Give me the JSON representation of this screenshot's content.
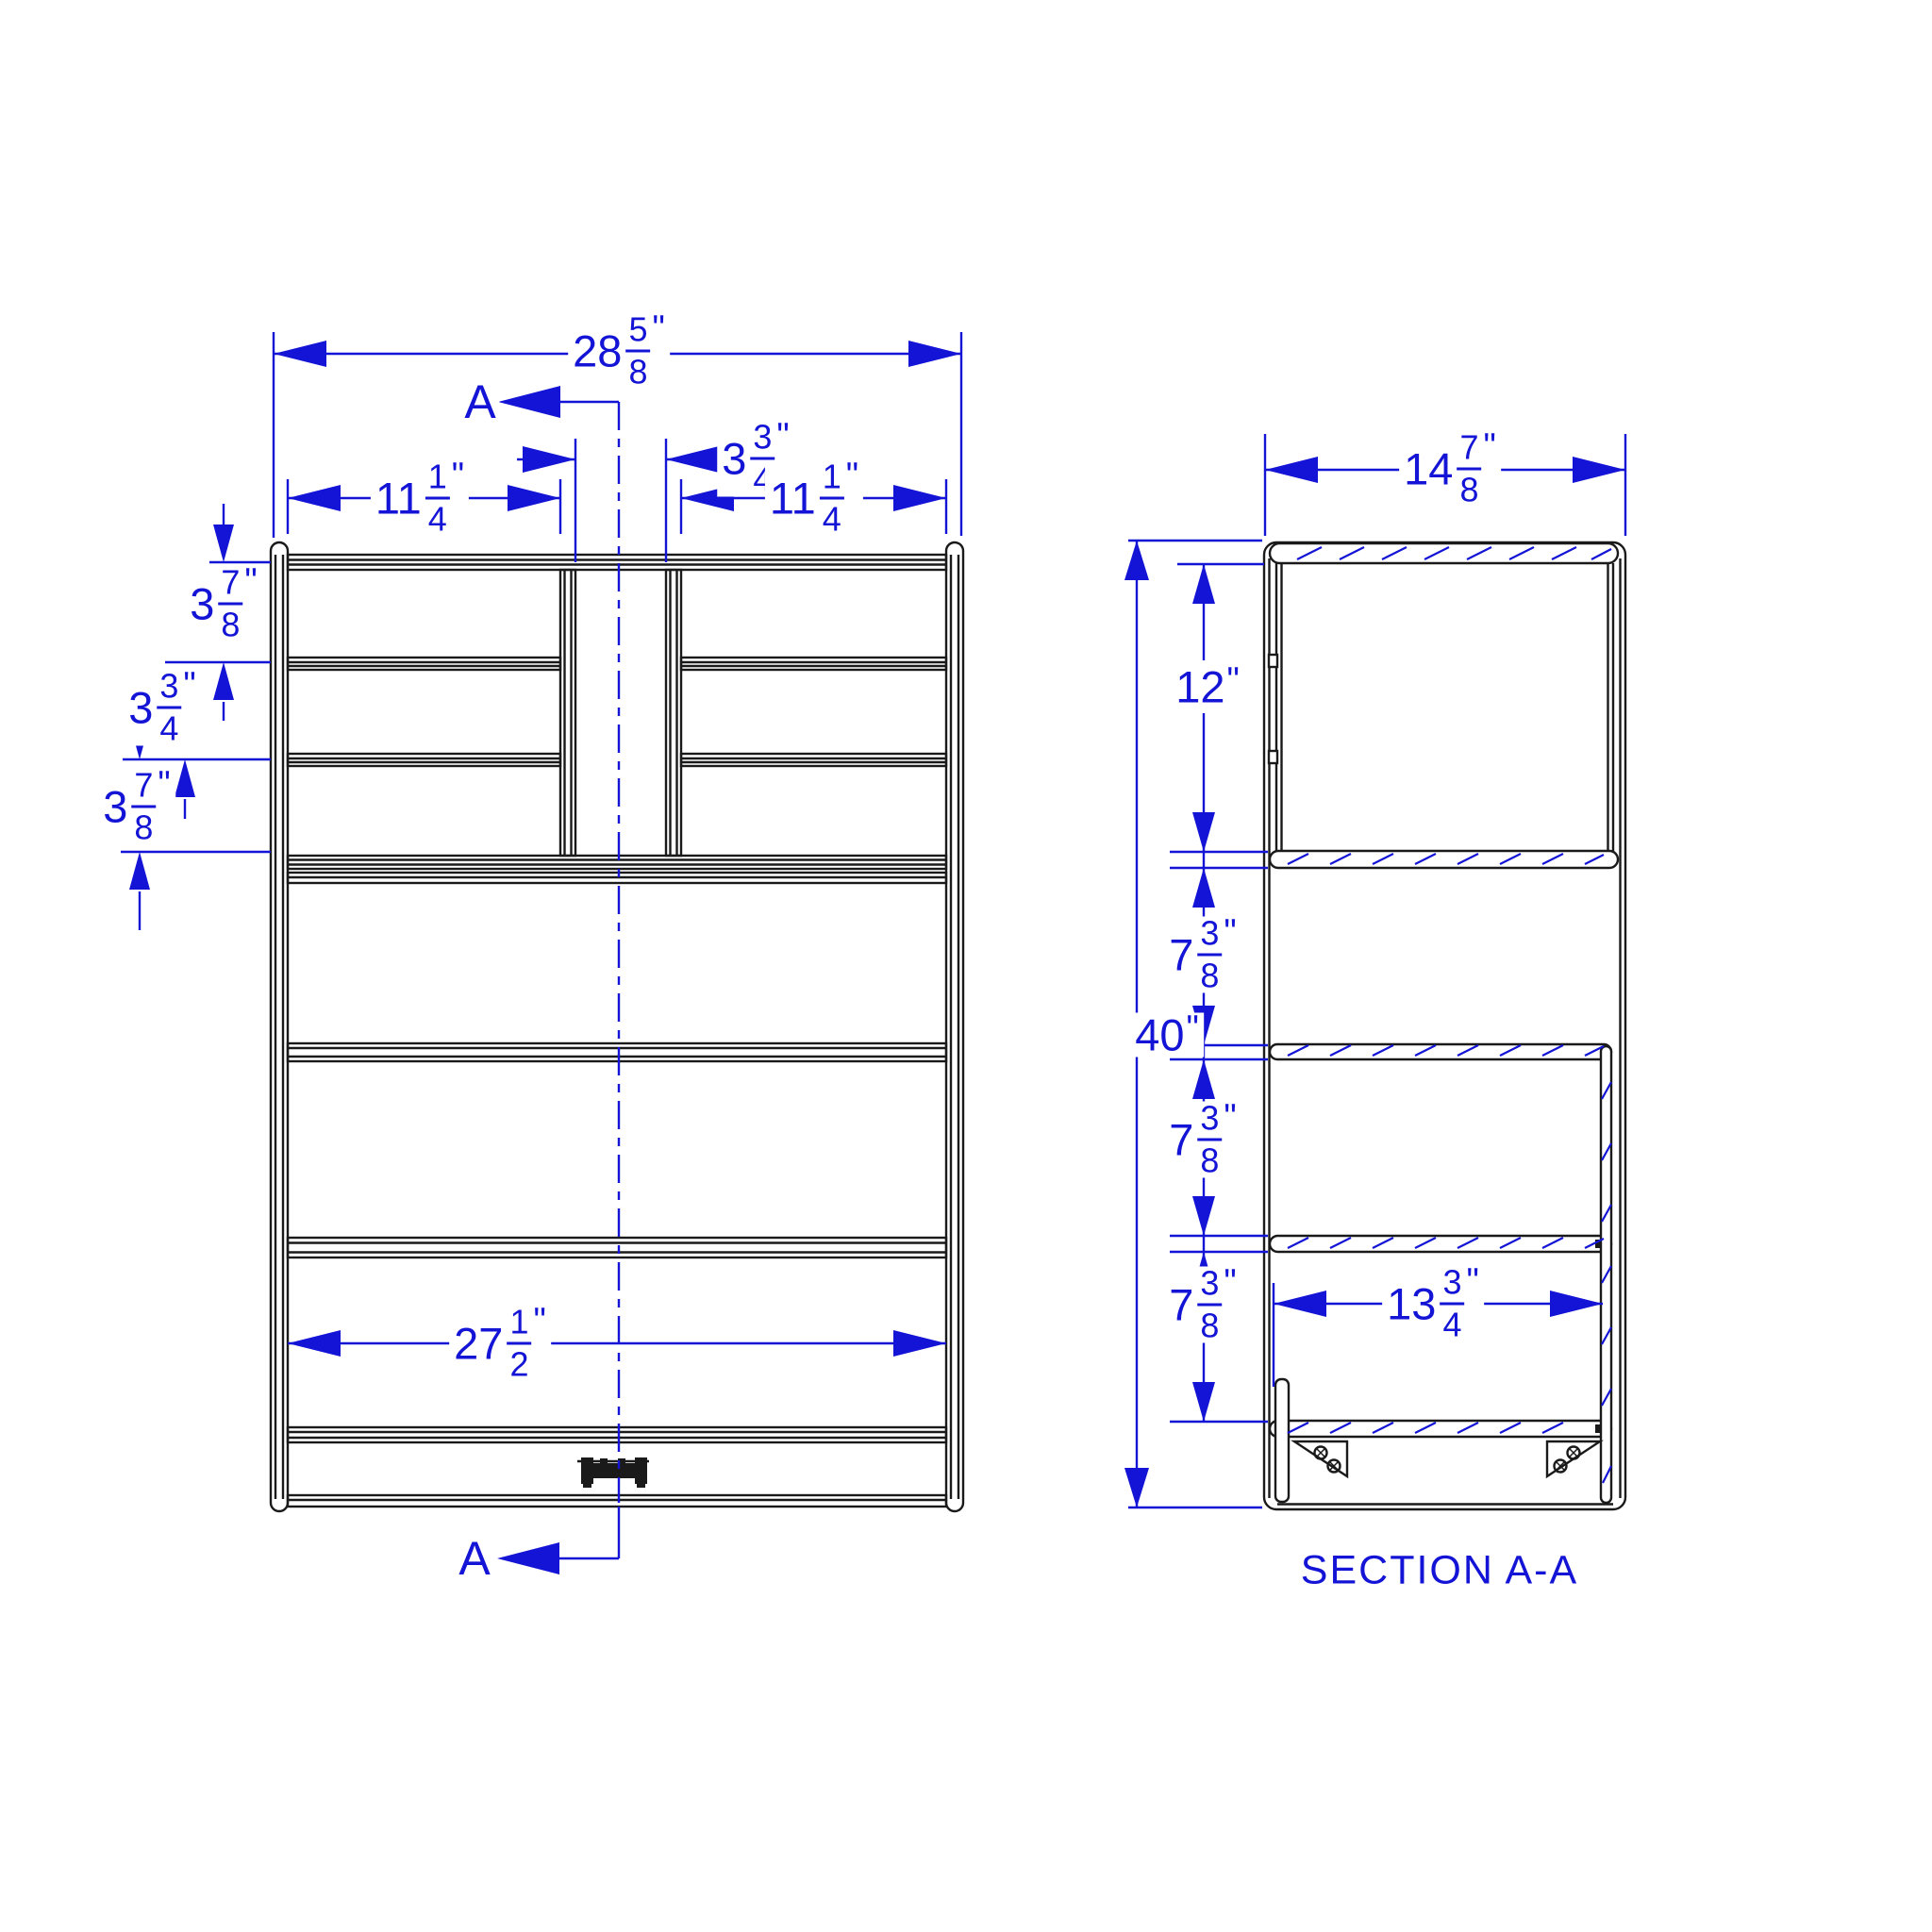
{
  "drawing": {
    "colors": {
      "background": "#ffffff",
      "line": "#1a1a1a",
      "dim": "#1414d6"
    },
    "section_label": "SECTION A-A",
    "markers": {
      "top": "A",
      "bottom": "A"
    },
    "front_view": {
      "dims": {
        "overall_width": {
          "whole": "28",
          "num": "5",
          "den": "8",
          "unit": "\""
        },
        "left_opening": {
          "whole": "11",
          "num": "1",
          "den": "4",
          "unit": "\""
        },
        "center_gap": {
          "whole": "3",
          "num": "3",
          "den": "4",
          "unit": "\""
        },
        "right_opening": {
          "whole": "11",
          "num": "1",
          "den": "4",
          "unit": "\""
        },
        "row_1": {
          "whole": "3",
          "num": "7",
          "den": "8",
          "unit": "\""
        },
        "row_2": {
          "whole": "3",
          "num": "3",
          "den": "4",
          "unit": "\""
        },
        "row_3": {
          "whole": "3",
          "num": "7",
          "den": "8",
          "unit": "\""
        },
        "inner_width": {
          "whole": "27",
          "num": "1",
          "den": "2",
          "unit": "\""
        }
      }
    },
    "section_view": {
      "dims": {
        "depth": {
          "whole": "14",
          "num": "7",
          "den": "8",
          "unit": "\""
        },
        "overall_height": {
          "whole": "40",
          "unit": "\""
        },
        "top_opening": {
          "whole": "12",
          "unit": "\""
        },
        "gap_1": {
          "whole": "7",
          "num": "3",
          "den": "8",
          "unit": "\""
        },
        "gap_2": {
          "whole": "7",
          "num": "3",
          "den": "8",
          "unit": "\""
        },
        "gap_3": {
          "whole": "7",
          "num": "3",
          "den": "8",
          "unit": "\""
        },
        "inner_depth": {
          "whole": "13",
          "num": "3",
          "den": "4",
          "unit": "\""
        }
      }
    }
  }
}
